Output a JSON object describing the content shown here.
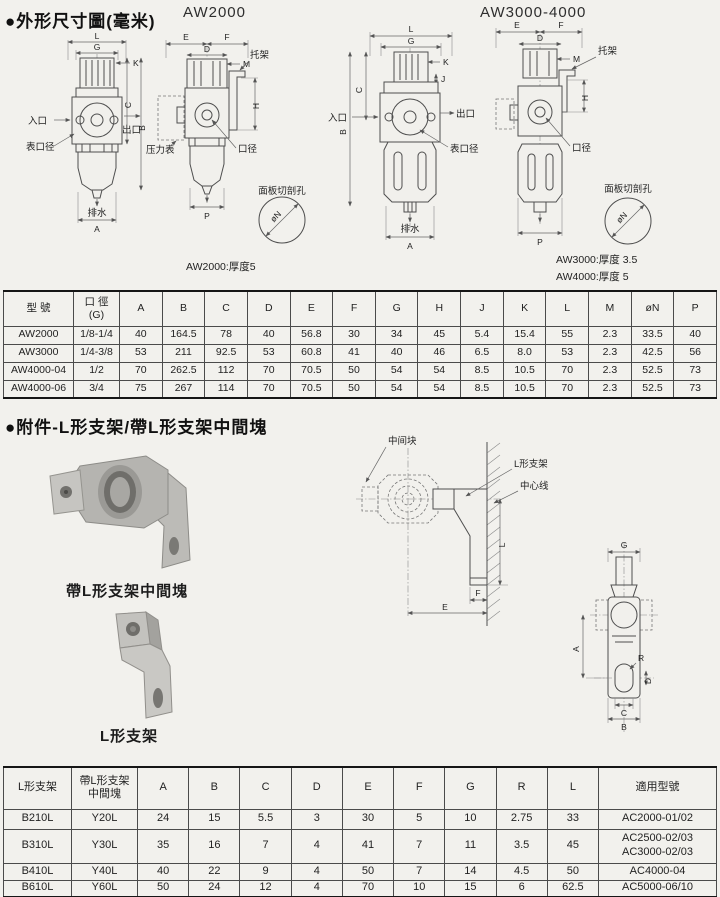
{
  "sections": {
    "dims_title": "●外形尺寸圖(毫米)",
    "accessory_title": "●附件-L形支架/帶L形支架中間塊"
  },
  "models": {
    "left": "AW2000",
    "right": "AW3000-4000"
  },
  "labels": {
    "inlet": "入口",
    "outlet": "出口",
    "gauge_port": "表口径",
    "drain": "排水",
    "pressure_gauge": "压力表",
    "bracket": "托架",
    "port": "口径",
    "panel_cutout": "面板切剖孔",
    "phi_n": "øN",
    "middle_block": "中间块",
    "l_bracket": "L形支架",
    "center_line": "中心线"
  },
  "dims": {
    "A": "A",
    "B": "B",
    "C": "C",
    "D": "D",
    "E": "E",
    "F": "F",
    "G": "G",
    "H": "H",
    "J": "J",
    "K": "K",
    "L": "L",
    "M": "M",
    "P": "P",
    "R": "R"
  },
  "notes": {
    "aw2000": "AW2000:厚度5",
    "aw3000": "AW3000:厚度 3.5",
    "aw4000": "AW4000:厚度 5"
  },
  "captions": {
    "photo1": "帶L形支架中間塊",
    "photo2": "L形支架"
  },
  "table1": {
    "headers": [
      "型 號",
      "口 徑\n(G)",
      "A",
      "B",
      "C",
      "D",
      "E",
      "F",
      "G",
      "H",
      "J",
      "K",
      "L",
      "M",
      "øN",
      "P"
    ],
    "rows": [
      [
        "AW2000",
        "1/8-1/4",
        "40",
        "164.5",
        "78",
        "40",
        "56.8",
        "30",
        "34",
        "45",
        "5.4",
        "15.4",
        "55",
        "2.3",
        "33.5",
        "40"
      ],
      [
        "AW3000",
        "1/4-3/8",
        "53",
        "211",
        "92.5",
        "53",
        "60.8",
        "41",
        "40",
        "46",
        "6.5",
        "8.0",
        "53",
        "2.3",
        "42.5",
        "56"
      ],
      [
        "AW4000-04",
        "1/2",
        "70",
        "262.5",
        "112",
        "70",
        "70.5",
        "50",
        "54",
        "54",
        "8.5",
        "10.5",
        "70",
        "2.3",
        "52.5",
        "73"
      ],
      [
        "AW4000-06",
        "3/4",
        "75",
        "267",
        "114",
        "70",
        "70.5",
        "50",
        "54",
        "54",
        "8.5",
        "10.5",
        "70",
        "2.3",
        "52.5",
        "73"
      ]
    ]
  },
  "table2": {
    "headers": [
      "L形支架",
      "帶L形支架\n中間塊",
      "A",
      "B",
      "C",
      "D",
      "E",
      "F",
      "G",
      "R",
      "L",
      "適用型號"
    ],
    "rows": [
      [
        "B210L",
        "Y20L",
        "24",
        "15",
        "5.5",
        "3",
        "30",
        "5",
        "10",
        "2.75",
        "33",
        "AC2000-01/02"
      ],
      [
        "B310L",
        "Y30L",
        "35",
        "16",
        "7",
        "4",
        "41",
        "7",
        "11",
        "3.5",
        "45",
        "AC2500-02/03\nAC3000-02/03"
      ],
      [
        "B410L",
        "Y40L",
        "40",
        "22",
        "9",
        "4",
        "50",
        "7",
        "14",
        "4.5",
        "50",
        "AC4000-04"
      ],
      [
        "B610L",
        "Y60L",
        "50",
        "24",
        "12",
        "4",
        "70",
        "10",
        "15",
        "6",
        "62.5",
        "AC5000-06/10"
      ]
    ]
  }
}
